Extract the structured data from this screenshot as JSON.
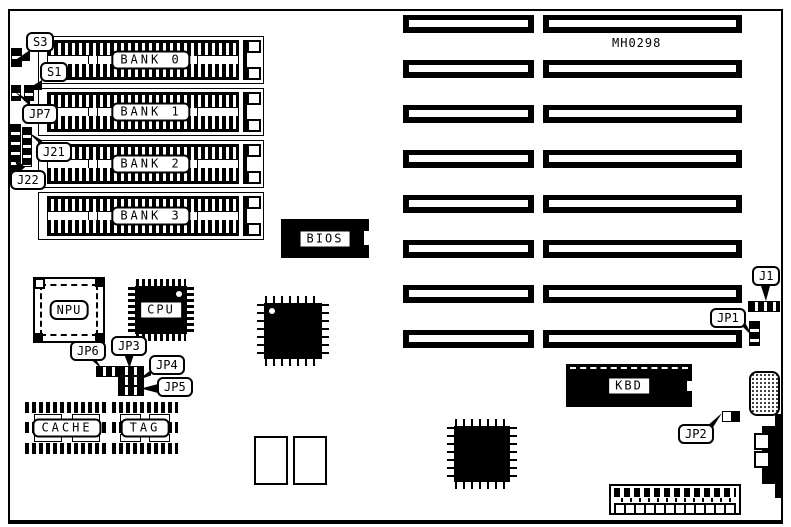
{
  "diagram": {
    "part_number": "MH0298",
    "memory_banks": [
      "BANK 0",
      "BANK 1",
      "BANK 2",
      "BANK 3"
    ],
    "chips": {
      "npu": "NPU",
      "cpu": "CPU",
      "bios": "BIOS",
      "kbd": "KBD",
      "cache": "CACHE",
      "tag": "TAG"
    },
    "callouts": {
      "s3": "S3",
      "s1": "S1",
      "jp7": "JP7",
      "j21": "J21",
      "j22": "J22",
      "jp6": "JP6",
      "jp3": "JP3",
      "jp4": "JP4",
      "jp5": "JP5",
      "j1": "J1",
      "jp1": "JP1",
      "jp2": "JP2"
    },
    "colors": {
      "ink": "#000000",
      "paper": "#ffffff"
    }
  }
}
